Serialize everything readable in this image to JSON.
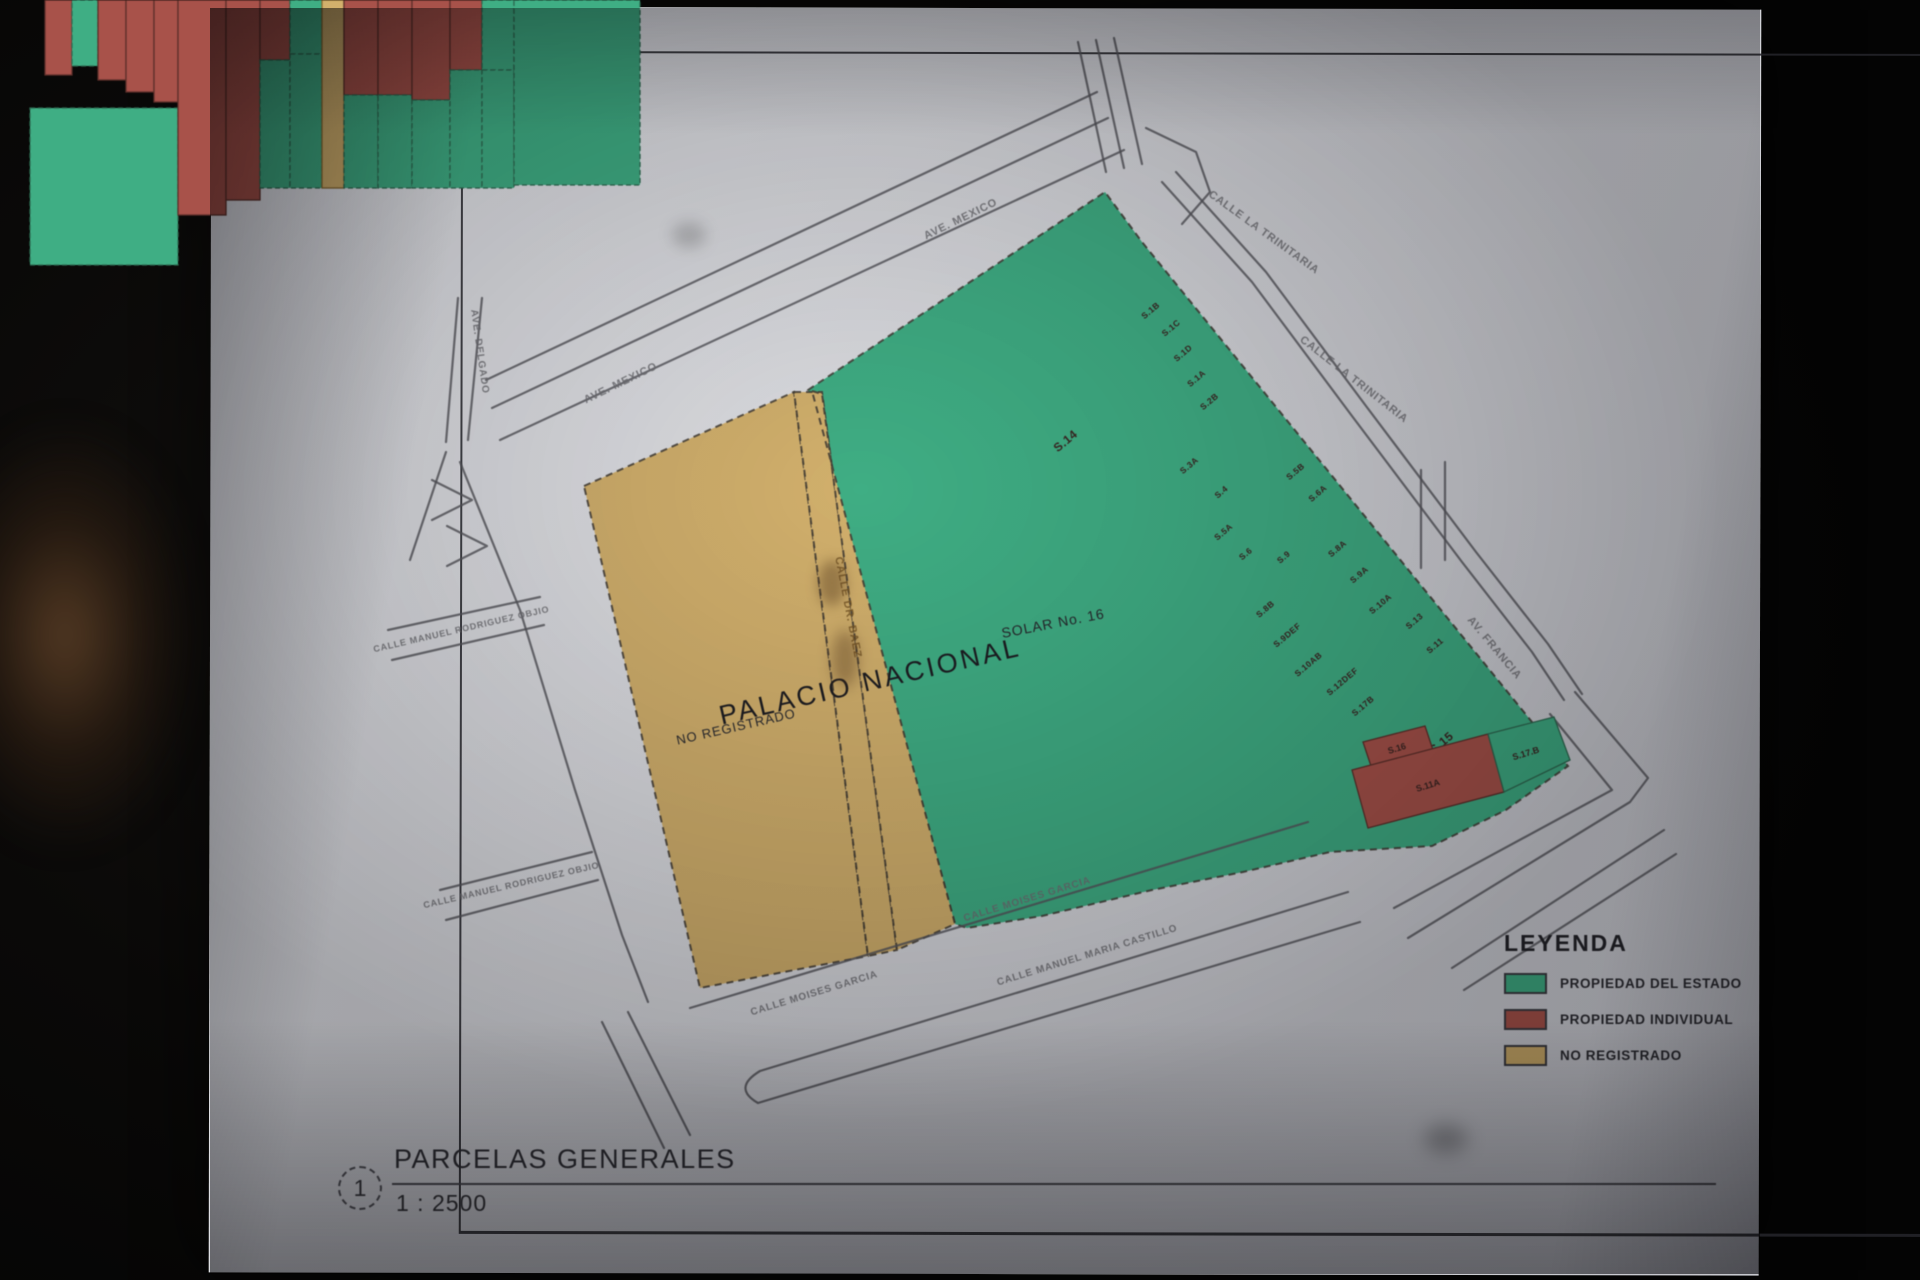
{
  "sheet": {
    "title": "PARCELAS GENERALES",
    "scale_label": "1 : 2500",
    "figure_number": "1"
  },
  "legend": {
    "title": "LEYENDA",
    "items": [
      {
        "label": "PROPIEDAD DEL ESTADO",
        "color": "#3fae84"
      },
      {
        "label": "PROPIEDAD INDIVIDUAL",
        "color": "#a8524a"
      },
      {
        "label": "NO REGISTRADO",
        "color": "#d2b06c"
      }
    ]
  },
  "map": {
    "colors": {
      "green": "#3fae84",
      "red": "#a8524a",
      "tan": "#d2b06c",
      "street": "#55555b",
      "boundary": "#3f3a33",
      "label_ink": "#3a2522",
      "street_ink": "#6f6f74"
    },
    "zones": [
      {
        "name": "parcel-solar-16",
        "color": "green",
        "points": [
          [
            808,
            390
          ],
          [
            1105,
            192
          ],
          [
            1142,
            242
          ],
          [
            1545,
            738
          ],
          [
            1568,
            766
          ],
          [
            1506,
            810
          ],
          [
            1432,
            846
          ],
          [
            1330,
            852
          ],
          [
            1243,
            872
          ],
          [
            1152,
            890
          ],
          [
            1042,
            916
          ],
          [
            967,
            928
          ],
          [
            955,
            924
          ]
        ]
      },
      {
        "name": "parcel-no-registrado",
        "color": "tan",
        "points": [
          [
            584,
            486
          ],
          [
            794,
            392
          ],
          [
            868,
            956
          ],
          [
            700,
            988
          ]
        ]
      },
      {
        "name": "street-dr-baez-sliver",
        "color": "tan",
        "points": [
          [
            794,
            392
          ],
          [
            822,
            392
          ],
          [
            897,
            950
          ],
          [
            868,
            956
          ]
        ]
      },
      {
        "name": "parcel-tan-strip",
        "color": "tan",
        "points": [
          [
            812,
            391
          ],
          [
            822,
            394
          ],
          [
            897,
            950
          ],
          [
            955,
            924
          ]
        ]
      }
    ],
    "cluster": {
      "origin": [
        1142,
        242
      ],
      "angle": 50,
      "rows": [
        {
          "x0": 45,
          "x1": 72,
          "cells": [
            {
              "y0": 0,
              "y1": 75,
              "c": "red",
              "l": "S.1B"
            }
          ]
        },
        {
          "x0": 72,
          "x1": 98,
          "cells": [
            {
              "y0": 0,
              "y1": 66,
              "c": "green",
              "l": "S.1C"
            }
          ]
        },
        {
          "x0": 98,
          "x1": 126,
          "cells": [
            {
              "y0": 0,
              "y1": 80,
              "c": "red",
              "l": "S.1D"
            }
          ]
        },
        {
          "x0": 126,
          "x1": 154,
          "cells": [
            {
              "y0": 0,
              "y1": 92,
              "c": "red",
              "l": "S.1A"
            }
          ]
        },
        {
          "x0": 154,
          "x1": 178,
          "cells": [
            {
              "y0": 0,
              "y1": 102,
              "c": "red",
              "l": "S.2B"
            }
          ]
        },
        {
          "x0": 30,
          "x1": 178,
          "cells": [
            {
              "y0": 108,
              "y1": 265,
              "c": "green",
              "l": "S.14",
              "big": true
            }
          ]
        },
        {
          "x0": 178,
          "x1": 226,
          "cells": [
            {
              "y0": 0,
              "y1": 215,
              "c": "red",
              "l": "S.3A"
            }
          ]
        },
        {
          "x0": 226,
          "x1": 260,
          "cells": [
            {
              "y0": 0,
              "y1": 200,
              "c": "red",
              "l": "S.4"
            }
          ]
        },
        {
          "x0": 260,
          "x1": 290,
          "cells": [
            {
              "y0": 0,
              "y1": 60,
              "c": "red",
              "l": "S.5B"
            },
            {
              "y0": 60,
              "y1": 188,
              "c": "green",
              "l": "S.5A"
            }
          ]
        },
        {
          "x0": 290,
          "x1": 322,
          "cells": [
            {
              "y0": 0,
              "y1": 54,
              "c": "green",
              "l": "S.6A"
            },
            {
              "y0": 54,
              "y1": 188,
              "c": "green",
              "l": "S.6"
            }
          ]
        },
        {
          "x0": 322,
          "x1": 344,
          "cells": [
            {
              "y0": 0,
              "y1": 188,
              "c": "tan",
              "l": "S.9"
            }
          ]
        },
        {
          "x0": 344,
          "x1": 378,
          "cells": [
            {
              "y0": 0,
              "y1": 95,
              "c": "red",
              "l": "S.8A"
            },
            {
              "y0": 95,
              "y1": 188,
              "c": "green",
              "l": "S.8B"
            }
          ]
        },
        {
          "x0": 378,
          "x1": 412,
          "cells": [
            {
              "y0": 0,
              "y1": 95,
              "c": "red",
              "l": "S.9A"
            },
            {
              "y0": 95,
              "y1": 188,
              "c": "green",
              "l": "S.9DEF"
            }
          ]
        },
        {
          "x0": 412,
          "x1": 450,
          "cells": [
            {
              "y0": 0,
              "y1": 100,
              "c": "red",
              "l": "S.10A"
            },
            {
              "y0": 100,
              "y1": 188,
              "c": "green",
              "l": "S.10AB"
            }
          ]
        },
        {
          "x0": 450,
          "x1": 482,
          "cells": [
            {
              "y0": 0,
              "y1": 70,
              "c": "red",
              "l": "S.13"
            },
            {
              "y0": 70,
              "y1": 188,
              "c": "green",
              "l": "S.12DEF"
            }
          ]
        },
        {
          "x0": 482,
          "x1": 514,
          "cells": [
            {
              "y0": 0,
              "y1": 70,
              "c": "green",
              "l": "S.11"
            },
            {
              "y0": 70,
              "y1": 188,
              "c": "green",
              "l": "S.17B"
            }
          ]
        },
        {
          "x0": 514,
          "x1": 640,
          "cells": [
            {
              "y0": 0,
              "y1": 185,
              "c": "green",
              "l": "S.15",
              "big": true
            }
          ]
        }
      ]
    },
    "corner_parcels": [
      {
        "label": "S.16",
        "color": "red",
        "points": [
          [
            1363,
            742
          ],
          [
            1425,
            726
          ],
          [
            1433,
            750
          ],
          [
            1371,
            766
          ]
        ],
        "lx": 1397,
        "ly": 749,
        "rot": -17
      },
      {
        "label": "S.11A",
        "color": "red",
        "points": [
          [
            1352,
            770
          ],
          [
            1488,
            734
          ],
          [
            1504,
            792
          ],
          [
            1368,
            828
          ]
        ],
        "lx": 1428,
        "ly": 786,
        "rot": -17
      },
      {
        "label": "S.17.B",
        "color": "green",
        "points": [
          [
            1488,
            734
          ],
          [
            1554,
            717
          ],
          [
            1570,
            760
          ],
          [
            1504,
            792
          ]
        ],
        "lx": 1526,
        "ly": 754,
        "rot": -17
      }
    ],
    "streets": [
      {
        "pts": [
          [
            1108,
            118
          ],
          [
            492,
            408
          ]
        ]
      },
      {
        "pts": [
          [
            1124,
            150
          ],
          [
            500,
            440
          ]
        ]
      },
      {
        "pts": [
          [
            1097,
            92
          ],
          [
            486,
            380
          ]
        ]
      },
      {
        "pts": [
          [
            1078,
            42
          ],
          [
            1106,
            172
          ]
        ]
      },
      {
        "pts": [
          [
            1096,
            40
          ],
          [
            1124,
            168
          ]
        ]
      },
      {
        "pts": [
          [
            1114,
            38
          ],
          [
            1142,
            164
          ]
        ]
      },
      {
        "pts": [
          [
            458,
            298
          ],
          [
            446,
            442
          ]
        ]
      },
      {
        "pts": [
          [
            482,
            298
          ],
          [
            468,
            440
          ]
        ]
      },
      {
        "pts": [
          [
            460,
            462
          ],
          [
            520,
            610
          ],
          [
            575,
            790
          ],
          [
            622,
            935
          ],
          [
            648,
            1002
          ]
        ]
      },
      {
        "pts": [
          [
            446,
            452
          ],
          [
            410,
            560
          ]
        ]
      },
      {
        "pts": [
          [
            1162,
            182
          ],
          [
            1252,
            282
          ],
          [
            1352,
            416
          ],
          [
            1462,
            562
          ],
          [
            1532,
            652
          ],
          [
            1564,
            700
          ]
        ]
      },
      {
        "pts": [
          [
            1176,
            172
          ],
          [
            1266,
            272
          ],
          [
            1366,
            406
          ],
          [
            1476,
            552
          ],
          [
            1548,
            644
          ],
          [
            1582,
            694
          ]
        ]
      },
      {
        "pts": [
          [
            1146,
            128
          ],
          [
            1196,
            152
          ],
          [
            1210,
            192
          ],
          [
            1182,
            224
          ]
        ]
      },
      {
        "pts": [
          [
            1421,
            470
          ],
          [
            1421,
            568
          ]
        ]
      },
      {
        "pts": [
          [
            1445,
            462
          ],
          [
            1445,
            560
          ]
        ]
      },
      {
        "pts": [
          [
            1575,
            692
          ],
          [
            1648,
            778
          ],
          [
            1630,
            802
          ],
          [
            1408,
            938
          ]
        ]
      },
      {
        "pts": [
          [
            1550,
            714
          ],
          [
            1612,
            790
          ],
          [
            1394,
            908
          ]
        ]
      },
      {
        "pts": [
          [
            1664,
            830
          ],
          [
            1452,
            968
          ]
        ]
      },
      {
        "pts": [
          [
            1676,
            854
          ],
          [
            1464,
            990
          ]
        ]
      },
      {
        "pts": [
          [
            690,
            1008
          ],
          [
            1308,
            822
          ]
        ]
      },
      {
        "d": "M1348,892 L760,1071 Q732,1088 758,1103 L1360,922"
      },
      {
        "pts": [
          [
            540,
            597
          ],
          [
            388,
            630
          ]
        ]
      },
      {
        "pts": [
          [
            544,
            625
          ],
          [
            392,
            660
          ]
        ]
      },
      {
        "pts": [
          [
            592,
            852
          ],
          [
            440,
            890
          ]
        ]
      },
      {
        "pts": [
          [
            598,
            880
          ],
          [
            446,
            920
          ]
        ]
      },
      {
        "pts": [
          [
            432,
            480
          ],
          [
            472,
            500
          ],
          [
            432,
            520
          ]
        ]
      },
      {
        "pts": [
          [
            447,
            526
          ],
          [
            487,
            546
          ],
          [
            447,
            566
          ]
        ]
      },
      {
        "pts": [
          [
            628,
            1012
          ],
          [
            690,
            1135
          ]
        ]
      },
      {
        "pts": [
          [
            602,
            1022
          ],
          [
            664,
            1148
          ]
        ]
      }
    ],
    "zone_labels": [
      {
        "t": "PALACIO NACIONAL",
        "x": 872,
        "y": 690,
        "r": -13,
        "s": 27,
        "c": "#1c1c21",
        "ls": 3
      },
      {
        "t": "NO REGISTRADO",
        "x": 737,
        "y": 731,
        "r": -13,
        "s": 13,
        "c": "#2a2a2f",
        "ls": 1
      },
      {
        "t": "SOLAR No. 16",
        "x": 1054,
        "y": 628,
        "r": -11,
        "s": 14,
        "c": "#26262b",
        "ls": 1
      }
    ],
    "street_labels": [
      {
        "t": "AVE. MEXICO",
        "x": 962,
        "y": 222,
        "r": -26,
        "s": 11
      },
      {
        "t": "AVE. MEXICO",
        "x": 622,
        "y": 386,
        "r": -26,
        "s": 11
      },
      {
        "t": "AVE. DELGADO",
        "x": 477,
        "y": 352,
        "r": 82,
        "s": 10
      },
      {
        "t": "CALLE LA TRINITARIA",
        "x": 1262,
        "y": 235,
        "r": 36,
        "s": 11
      },
      {
        "t": "CALLE LA TRINITARIA",
        "x": 1352,
        "y": 382,
        "r": 38,
        "s": 11
      },
      {
        "t": "AV. FRANCIA",
        "x": 1492,
        "y": 650,
        "r": 50,
        "s": 11
      },
      {
        "t": "CALLE MOISES GARCIA",
        "x": 1028,
        "y": 902,
        "r": -17,
        "s": 10
      },
      {
        "t": "CALLE MOISES GARCIA",
        "x": 815,
        "y": 996,
        "r": -17,
        "s": 10
      },
      {
        "t": "CALLE MANUEL MARIA CASTILLO",
        "x": 1088,
        "y": 958,
        "r": -17,
        "s": 10
      },
      {
        "t": "CALLE MANUEL RODRIGUEZ OBJIO",
        "x": 462,
        "y": 632,
        "r": -13,
        "s": 9
      },
      {
        "t": "CALLE MANUEL RODRIGUEZ OBJIO",
        "x": 512,
        "y": 888,
        "r": -13,
        "s": 9
      },
      {
        "t": "CALLE DR. BAEZ",
        "x": 845,
        "y": 608,
        "r": 79,
        "s": 11,
        "c": "#7a5a28"
      }
    ]
  }
}
